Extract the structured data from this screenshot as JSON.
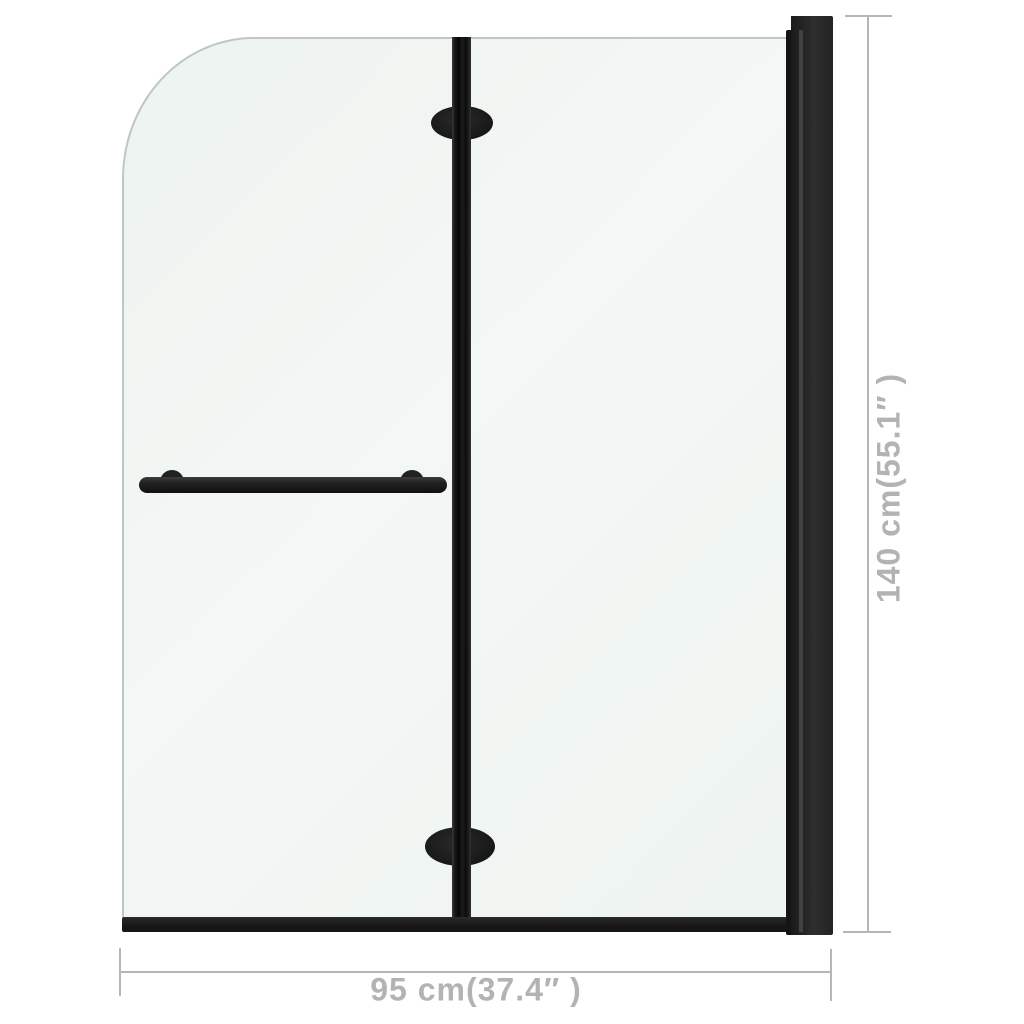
{
  "diagram": {
    "subject": "folding-shower-bath-screen",
    "width_dimension": {
      "label": "95 cm(37.4″ )"
    },
    "height_dimension": {
      "label": "140 cm(55.1″ )"
    },
    "colors": {
      "background": "#ffffff",
      "glass_fill": "#f0f5f3",
      "glass_edge": "#c0c6c3",
      "frame_black": "#1d1d1d",
      "dimension_gray": "#b3b3b3"
    }
  }
}
